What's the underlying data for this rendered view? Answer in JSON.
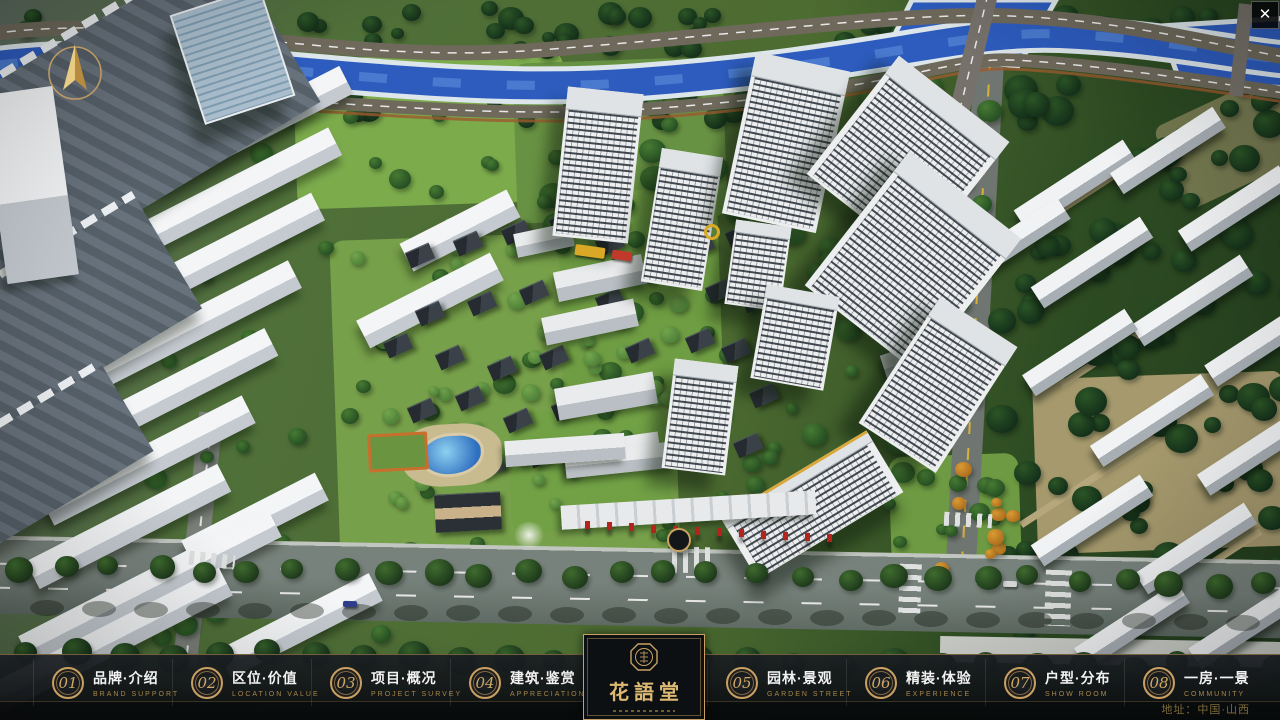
{
  "header": {
    "close_icon": "✕"
  },
  "nav": {
    "items": [
      {
        "num": "01",
        "label": "品牌·介绍",
        "sub": "BRAND SUPPORT"
      },
      {
        "num": "02",
        "label": "区位·价值",
        "sub": "LOCATION VALUE"
      },
      {
        "num": "03",
        "label": "项目·概况",
        "sub": "PROJECT SURVEY"
      },
      {
        "num": "04",
        "label": "建筑·鉴赏",
        "sub": "APPRECIATION"
      },
      {
        "num": "05",
        "label": "园林·景观",
        "sub": "GARDEN STREET"
      },
      {
        "num": "06",
        "label": "精装·体验",
        "sub": "EXPERIENCE"
      },
      {
        "num": "07",
        "label": "户型·分布",
        "sub": "SHOW ROOM"
      },
      {
        "num": "08",
        "label": "一房·一景",
        "sub": "COMMUNITY"
      }
    ]
  },
  "logo": {
    "title": "花語堂"
  },
  "footer": {
    "address": "地址：中国·山西"
  },
  "colors": {
    "gold": "#c9a063",
    "river": "#2d5cbe",
    "bar_bg": "#14181c"
  }
}
